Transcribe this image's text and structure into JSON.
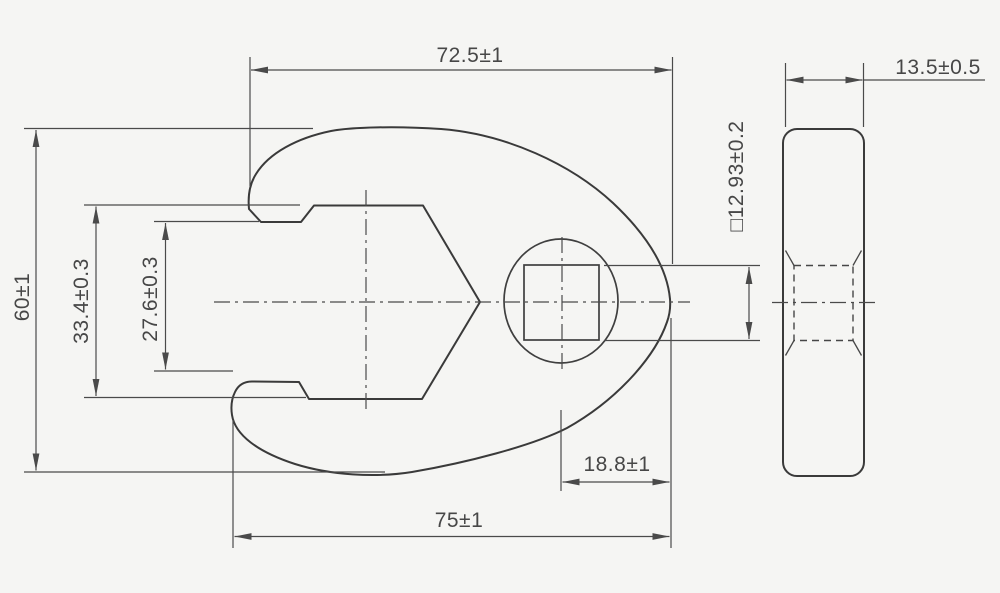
{
  "drawing": {
    "type": "technical-drawing",
    "subject": "crowfoot-wrench",
    "colors": {
      "background": "#f5f5f3",
      "outline": "#3a3a3a",
      "dimension": "#4a4a4a"
    },
    "dimensions": {
      "top_width": "72.5±1",
      "overall_height": "60±1",
      "jaw_outer_width": "33.4±0.3",
      "jaw_opening": "27.6±0.3",
      "bottom_width": "75±1",
      "drive_center_to_edge": "18.8±1",
      "square_drive": "□12.93±0.2",
      "thickness": "13.5±0.5"
    }
  }
}
